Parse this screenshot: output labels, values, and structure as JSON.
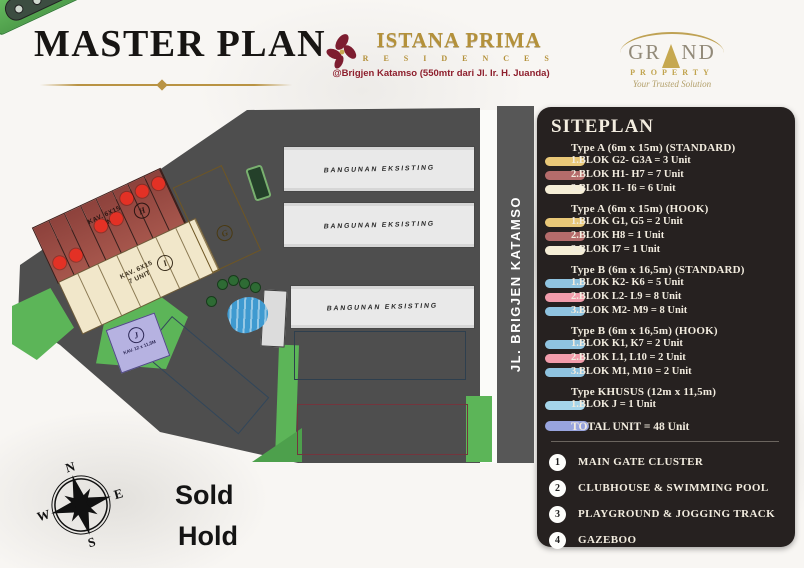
{
  "header": {
    "title": "MASTER PLAN",
    "brand": {
      "name": "ISTANA PRIMA",
      "sub": "R E S I D E N C E S",
      "address": "@Brigjen Katamso (550mtr dari Jl. Ir. H. Juanda)"
    },
    "developer": {
      "prefix": "GR",
      "suffix": "ND",
      "word": "PROPERTY",
      "tagline": "Your Trusted Solution"
    }
  },
  "siteplan": {
    "title": "SITEPLAN",
    "sections": [
      {
        "header": "Type A (6m x 15m) (STANDARD)",
        "items": [
          {
            "text": "1.BLOK G2- G3A = 3 Unit",
            "color": "#e9c878"
          },
          {
            "text": "2.BLOK H1- H7 = 7 Unit",
            "color": "#b56c6b"
          },
          {
            "text": "3.BLOK I1- I6 = 6 Unit",
            "color": "#f5eed6"
          }
        ]
      },
      {
        "header": "Type A (6m x 15m) (HOOK)",
        "items": [
          {
            "text": "1.BLOK G1, G5 = 2 Unit",
            "color": "#e9c878"
          },
          {
            "text": "2.BLOK H8 = 1 Unit",
            "color": "#b56c6b"
          },
          {
            "text": "3.BLOK I7 = 1 Unit",
            "color": "#f5eed6"
          }
        ]
      },
      {
        "header": "Type B (6m x 16,5m) (STANDARD)",
        "items": [
          {
            "text": "1.BLOK K2- K6 = 5 Unit",
            "color": "#8fc3e0"
          },
          {
            "text": "2.BLOK L2- L9 = 8 Unit",
            "color": "#f29cab"
          },
          {
            "text": "3.BLOK M2- M9 = 8 Unit",
            "color": "#8fc3e0"
          }
        ]
      },
      {
        "header": "Type B (6m x 16,5m) (HOOK)",
        "items": [
          {
            "text": "1.BLOK K1, K7 = 2 Unit",
            "color": "#8fc3e0"
          },
          {
            "text": "2.BLOK L1, L10 = 2 Unit",
            "color": "#f29cab"
          },
          {
            "text": "3.BLOK M1, M10 = 2 Unit",
            "color": "#8fc3e0"
          }
        ]
      },
      {
        "header": "Type KHUSUS (12m x 11,5m)",
        "items": [
          {
            "text": "1.BLOK J = 1 Unit",
            "color": "#a5d5ea"
          }
        ]
      }
    ],
    "total": {
      "text": "TOTAL UNIT = 48 Unit",
      "color": "#98a4de"
    },
    "facilities": [
      {
        "num": "1",
        "label": "MAIN GATE CLUSTER"
      },
      {
        "num": "2",
        "label": "CLUBHOUSE & SWIMMING POOL"
      },
      {
        "num": "3",
        "label": "PLAYGROUND & JOGGING TRACK"
      },
      {
        "num": "4",
        "label": "GAZEBOO"
      }
    ]
  },
  "map": {
    "road_label": "JL. BRIGJEN KATAMSO",
    "existing_building_label": "BANGUNAN EKSISTING",
    "blocks": {
      "h": {
        "letter": "H",
        "caption_1": "KAV. 6X15",
        "caption_2": "8 UNIT",
        "units": 8,
        "sold": [
          0,
          1,
          3,
          4,
          5,
          6,
          7
        ]
      },
      "i": {
        "letter": "I",
        "caption_1": "KAV. 6X15",
        "caption_2": "7 UNIT",
        "units": 7
      },
      "g": {
        "letter": "G",
        "units": 5,
        "sold": [
          0,
          1,
          4
        ]
      },
      "j": {
        "letter": "J",
        "caption": "KAV. 12 x 11,5M"
      },
      "k": {
        "units": 7,
        "sold": [
          0,
          1,
          2,
          3,
          4,
          5
        ]
      },
      "m": {
        "labels": [
          "M1",
          "M2",
          "M3",
          "M3A",
          "M5",
          "M6",
          "M7",
          "M8",
          "M9",
          "M10"
        ],
        "sold": [
          0,
          1,
          2,
          4,
          6,
          7,
          8,
          9
        ]
      },
      "l": {
        "labels": [
          "L1",
          "L2",
          "L3",
          "L3A",
          "L5",
          "L6",
          "L7",
          "L8",
          "L9",
          "L10"
        ],
        "sold": [
          2,
          5,
          6,
          7,
          8,
          9
        ]
      }
    },
    "markers": [
      {
        "num": "1",
        "x": 247,
        "y": 148
      },
      {
        "num": "3",
        "x": 259,
        "y": 190
      },
      {
        "num": "3",
        "x": 48,
        "y": 207
      },
      {
        "num": "3",
        "x": 187,
        "y": 144
      },
      {
        "num": "4",
        "x": 122,
        "y": 172
      },
      {
        "num": "2",
        "x": 268,
        "y": 301
      }
    ]
  },
  "legend": {
    "sold": "Sold",
    "hold": "Hold",
    "sold_color": "#e8392c",
    "hold_color": "#e7e32b"
  },
  "compass": {
    "n": "N",
    "e": "E",
    "s": "S",
    "w": "W"
  }
}
